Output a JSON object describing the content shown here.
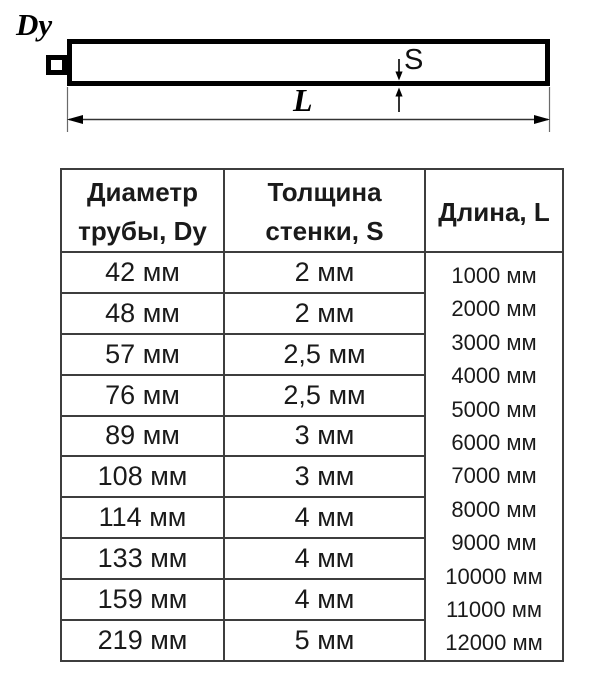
{
  "diagram": {
    "diameter_label": "Dy",
    "wall_thickness_label": "S",
    "length_label": "L"
  },
  "table": {
    "header": {
      "diameter_line1": "Диаметр",
      "diameter_line2": "трубы, Dy",
      "thickness_line1": "Толщина",
      "thickness_line2": "стенки, S",
      "length": "Длина, L"
    },
    "rows": [
      {
        "diameter": "42 мм",
        "thickness": "2 мм"
      },
      {
        "diameter": "48 мм",
        "thickness": "2 мм"
      },
      {
        "diameter": "57 мм",
        "thickness": "2,5 мм"
      },
      {
        "diameter": "76 мм",
        "thickness": "2,5 мм"
      },
      {
        "diameter": "89 мм",
        "thickness": "3 мм"
      },
      {
        "diameter": "108 мм",
        "thickness": "3 мм"
      },
      {
        "diameter": "114 мм",
        "thickness": "4 мм"
      },
      {
        "diameter": "133 мм",
        "thickness": "4 мм"
      },
      {
        "diameter": "159 мм",
        "thickness": "4 мм"
      },
      {
        "diameter": "219 мм",
        "thickness": "5 мм"
      }
    ],
    "lengths": [
      "1000 мм",
      "2000 мм",
      "3000 мм",
      "4000 мм",
      "5000 мм",
      "6000 мм",
      "7000 мм",
      "8000 мм",
      "9000 мм",
      "10000 мм",
      "11000 мм",
      "12000 мм"
    ]
  },
  "colors": {
    "text": "#1a1a1a",
    "table_border": "#3d3d3d",
    "drawing_line": "#000000"
  }
}
